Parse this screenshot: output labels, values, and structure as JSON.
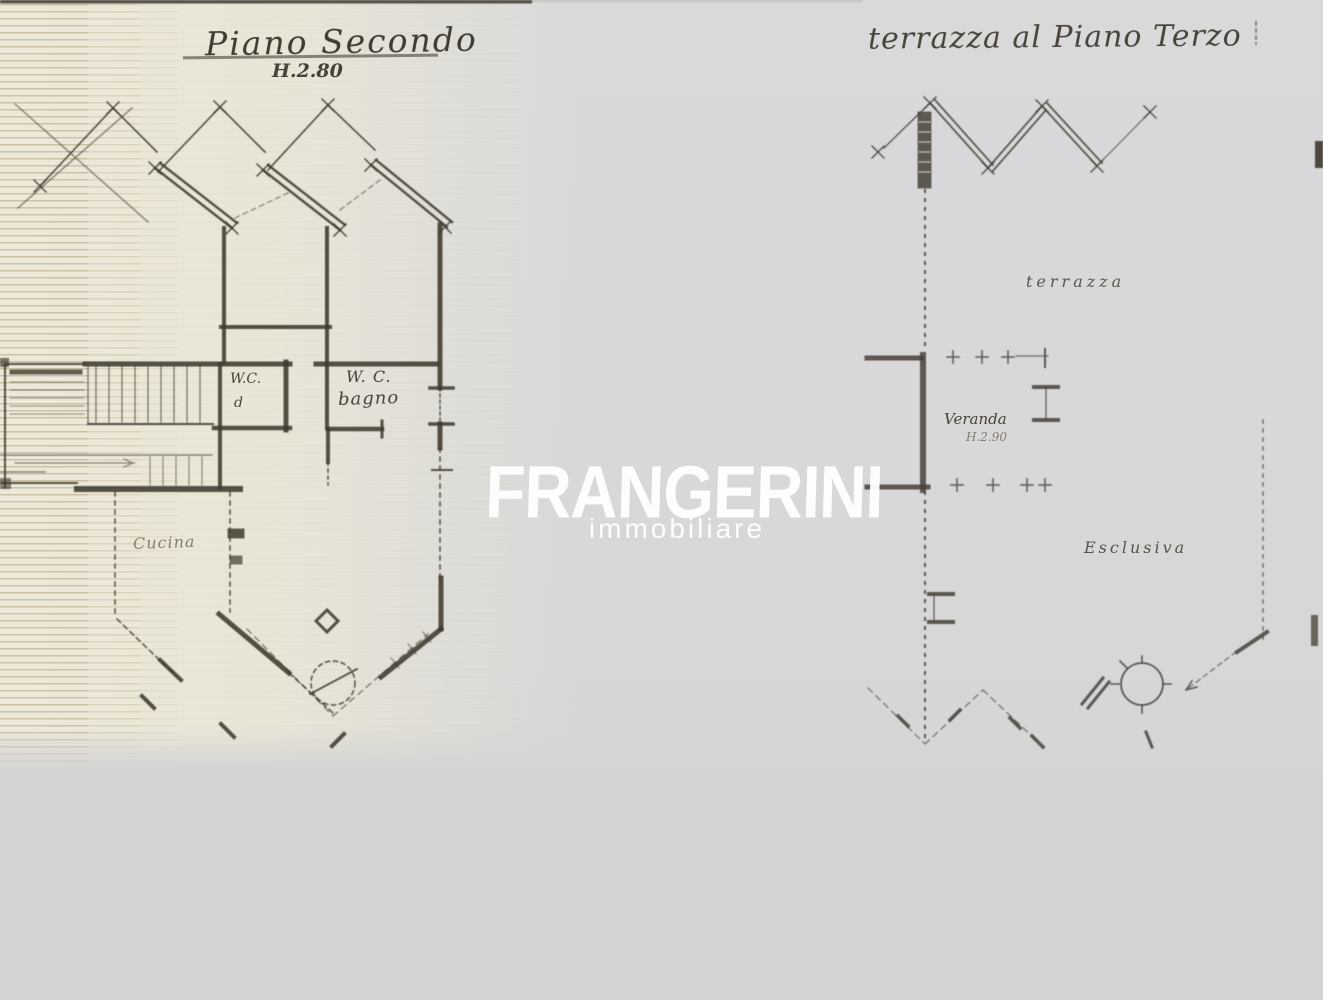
{
  "colors": {
    "background": "#d4d4d5",
    "paper_warm": "#ece8d9",
    "ink": "#3f3a2f",
    "watermark": "#ffffff"
  },
  "watermark": {
    "brand": "FRANGERINI",
    "subtitle": "immobiliare"
  },
  "left_plan": {
    "title": "Piano Secondo",
    "height_note": "H.2.80",
    "labels": {
      "wc": "W.C.",
      "wc_sub": "d",
      "bagno_title": "W. C.",
      "bagno_sub": "bagno",
      "cucina": "Cucina"
    }
  },
  "right_plan": {
    "title": "terrazza al Piano Terzo",
    "labels": {
      "terrazza": "terrazza",
      "veranda": "Veranda",
      "veranda_height": "H.2.90",
      "esclusiva": "Esclusiva"
    }
  }
}
